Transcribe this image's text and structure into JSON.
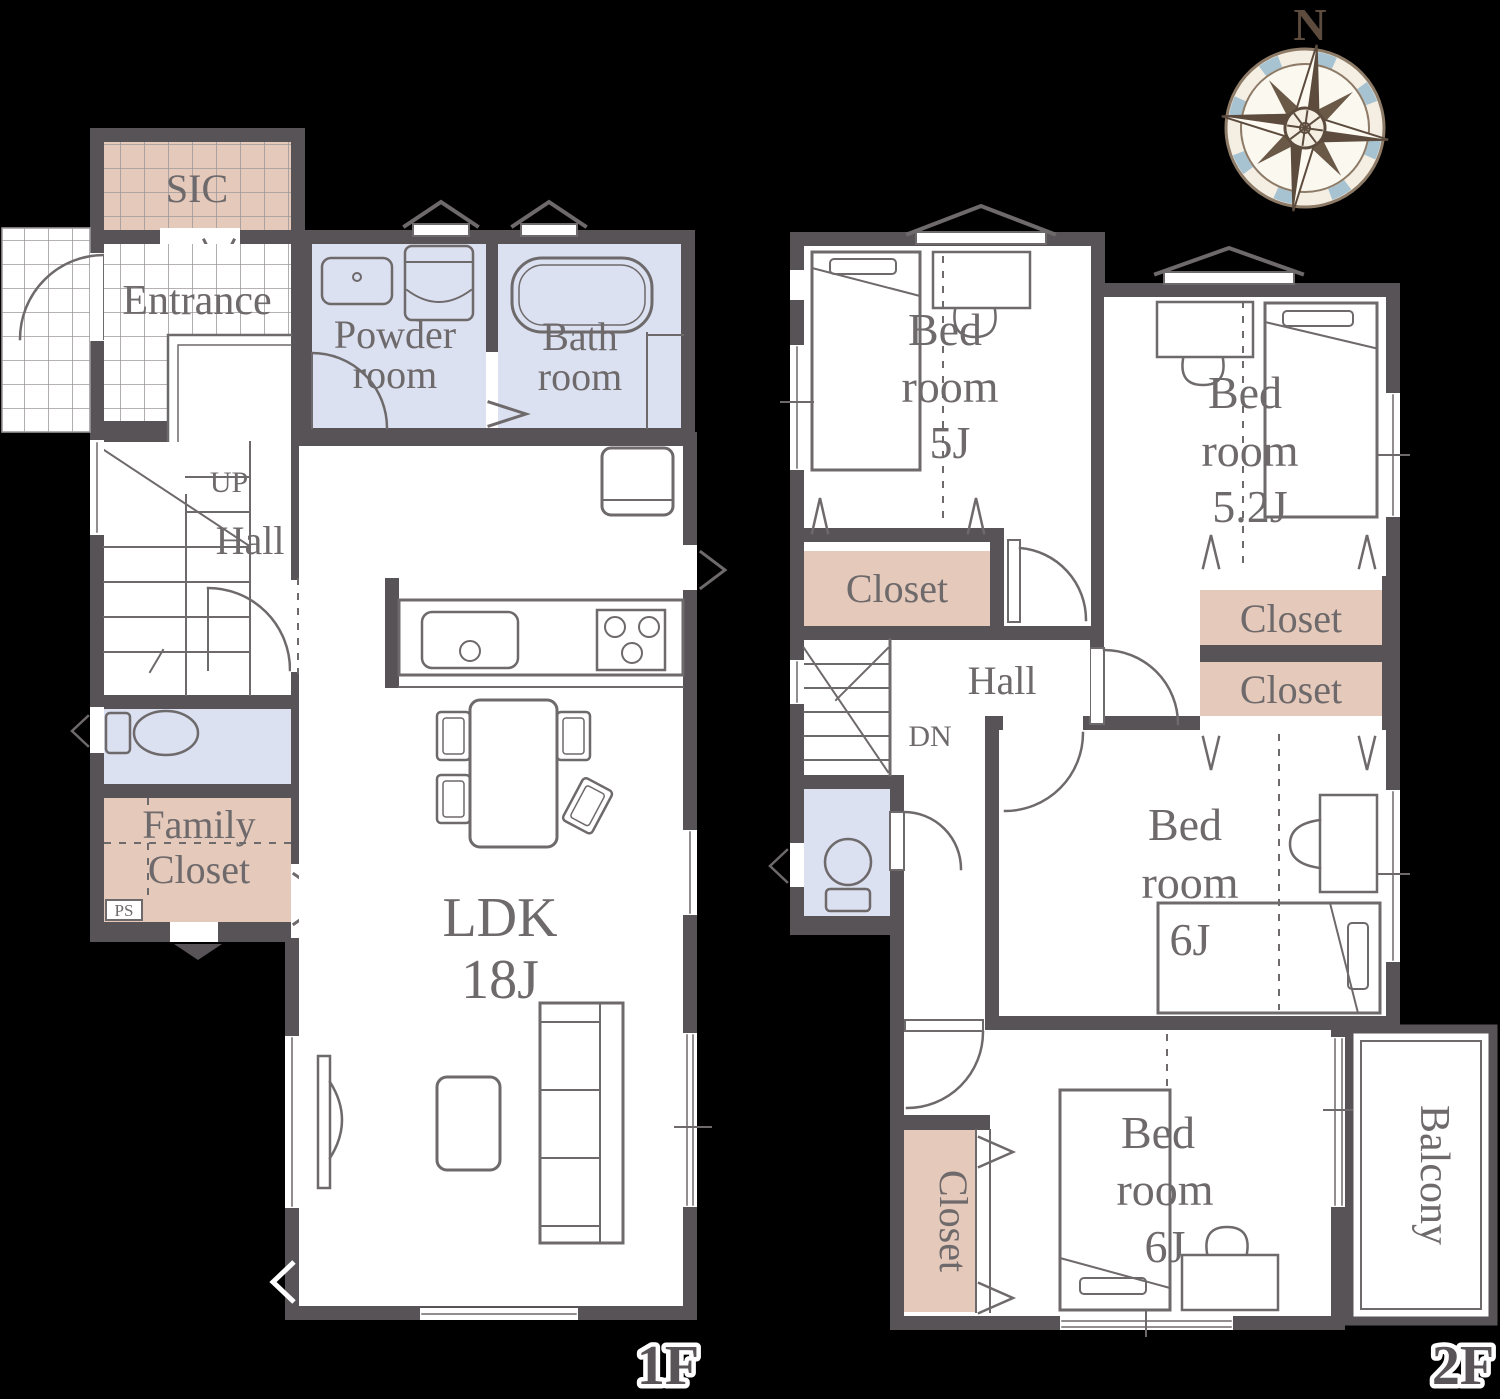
{
  "compass": {
    "north": "N"
  },
  "floor1": {
    "label": "1F",
    "sic": "SIC",
    "entrance": "Entrance",
    "powder_l1": "Powder",
    "powder_l2": "room",
    "bath_l1": "Bath",
    "bath_l2": "room",
    "up": "UP",
    "hall": "Hall",
    "family_l1": "Family",
    "family_l2": "Closet",
    "ps": "PS",
    "ldk_l1": "LDK",
    "ldk_l2": "18J"
  },
  "floor2": {
    "label": "2F",
    "bed5_l1": "Bed",
    "bed5_l2": "room",
    "bed5_l3": "5J",
    "bed52_l1": "Bed",
    "bed52_l2": "room",
    "bed52_l3": "5.2J",
    "bed6a_l1": "Bed",
    "bed6a_l2": "room",
    "bed6a_l3": "6J",
    "bed6b_l1": "Bed",
    "bed6b_l2": "room",
    "bed6b_l3": "6J",
    "closet_5j": "Closet",
    "closet_52a": "Closet",
    "closet_52b": "Closet",
    "closet_6b": "Closet",
    "hall": "Hall",
    "dn": "DN",
    "balcony": "Balcony"
  },
  "colors": {
    "wall": "#575357",
    "line": "#6e696b",
    "closet_fill": "#e5c9bb",
    "water_fill": "#dbe1f0",
    "floor_fill": "#ffffff",
    "background": "#000000",
    "compass_brown": "#5d4c3e",
    "compass_blue": "#a7c3d2",
    "compass_cream": "#f5efe3"
  }
}
